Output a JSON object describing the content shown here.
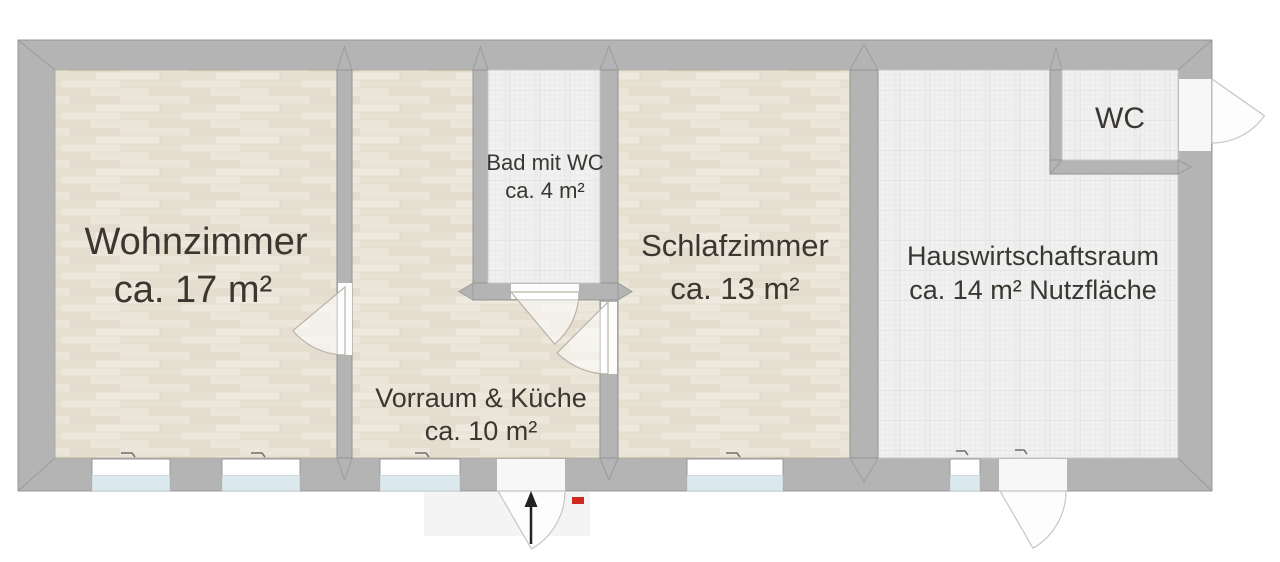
{
  "rooms": [
    {
      "name": "Wohnzimmer",
      "area": "ca. 17 m²",
      "floor": "wood"
    },
    {
      "name": "Vorraum & Küche",
      "area": "ca. 10 m²",
      "floor": "wood"
    },
    {
      "name": "Bad mit WC",
      "area": "ca. 4 m²",
      "floor": "tile"
    },
    {
      "name": "Schlafzimmer",
      "area": "ca. 13 m²",
      "floor": "wood"
    },
    {
      "name": "Hauswirtschaftsraum",
      "area": "ca. 14 m² Nutzfläche",
      "floor": "tile"
    },
    {
      "name": "WC",
      "floor": "tile"
    }
  ],
  "symbols": {
    "entrance_arrow": "↑",
    "entrance_marker": "red rectangle",
    "door_swings": 6,
    "windows": 5
  },
  "colors": {
    "wall": "#b4b4b4",
    "wall_edge": "#8f8f8f",
    "wood_floor": "#e9e3d7",
    "tile_floor": "#f1f1f1",
    "window_glass": "#dbe8ee",
    "entrance_marker_red": "#cf2a21",
    "label_text": "#3a3731"
  }
}
